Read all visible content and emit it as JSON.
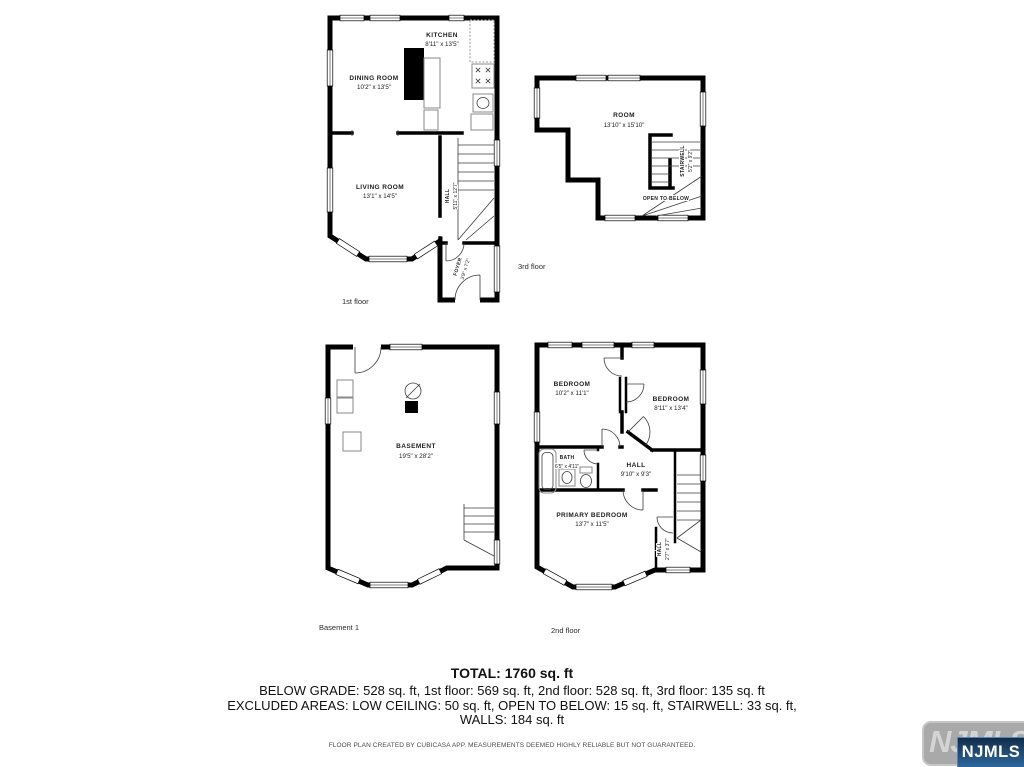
{
  "plans": {
    "first_floor": {
      "caption": "1st floor",
      "rooms": {
        "kitchen": {
          "name": "KITCHEN",
          "dims": "8'11\" x 13'5\""
        },
        "dining": {
          "name": "DINING ROOM",
          "dims": "10'2\" x 13'5\""
        },
        "living": {
          "name": "LIVING ROOM",
          "dims": "13'1\" x 14'5\""
        },
        "hall": {
          "name": "HALL",
          "dims": "5'11\" x 12'7\""
        },
        "foyer": {
          "name": "FOYER",
          "dims": "3'9\" x 7'2\""
        }
      }
    },
    "third_floor": {
      "caption": "3rd floor",
      "rooms": {
        "room": {
          "name": "ROOM",
          "dims": "13'10\" x 15'10\""
        },
        "stairwell": {
          "name": "STAIRWELL",
          "dims": "5'2\" x 9'2\""
        },
        "open_to_below": {
          "name": "OPEN TO BELOW"
        }
      }
    },
    "basement": {
      "caption": "Basement 1",
      "rooms": {
        "basement": {
          "name": "BASEMENT",
          "dims": "19'5\" x 28'2\""
        }
      }
    },
    "second_floor": {
      "caption": "2nd floor",
      "rooms": {
        "bedroom1": {
          "name": "BEDROOM",
          "dims": "10'2\" x 11'1\""
        },
        "bedroom2": {
          "name": "BEDROOM",
          "dims": "8'11\" x 13'4\""
        },
        "bath": {
          "name": "BATH",
          "dims": "6'5\" x 4'11\""
        },
        "hall": {
          "name": "HALL",
          "dims": "9'10\" x 9'3\""
        },
        "primary": {
          "name": "PRIMARY BEDROOM",
          "dims": "13'7\" x 11'5\""
        },
        "hall2": {
          "name": "HALL",
          "dims": "2'7\" x 3'7\""
        }
      }
    }
  },
  "summary": {
    "total": "TOTAL: 1760 sq. ft",
    "line1": "BELOW GRADE: 528 sq. ft, 1st floor: 569 sq. ft, 2nd floor: 528 sq. ft, 3rd floor: 135 sq. ft",
    "line2": "EXCLUDED AREAS: LOW CEILING: 50 sq. ft, OPEN TO BELOW: 15 sq. ft, STAIRWELL: 33 sq. ft,",
    "line3": "WALLS: 184 sq. ft"
  },
  "footer": {
    "disclaimer": "FLOOR PLAN CREATED BY CUBICASA APP. MEASUREMENTS DEEMED HIGHLY RELIABLE BUT NOT GUARANTEED."
  },
  "watermark": {
    "label": "NJMLS",
    "colors": {
      "wall": "#000000",
      "plate": "#a9a9a9",
      "badge_top": "#122c4a",
      "badge_bottom": "#2e679c"
    }
  }
}
